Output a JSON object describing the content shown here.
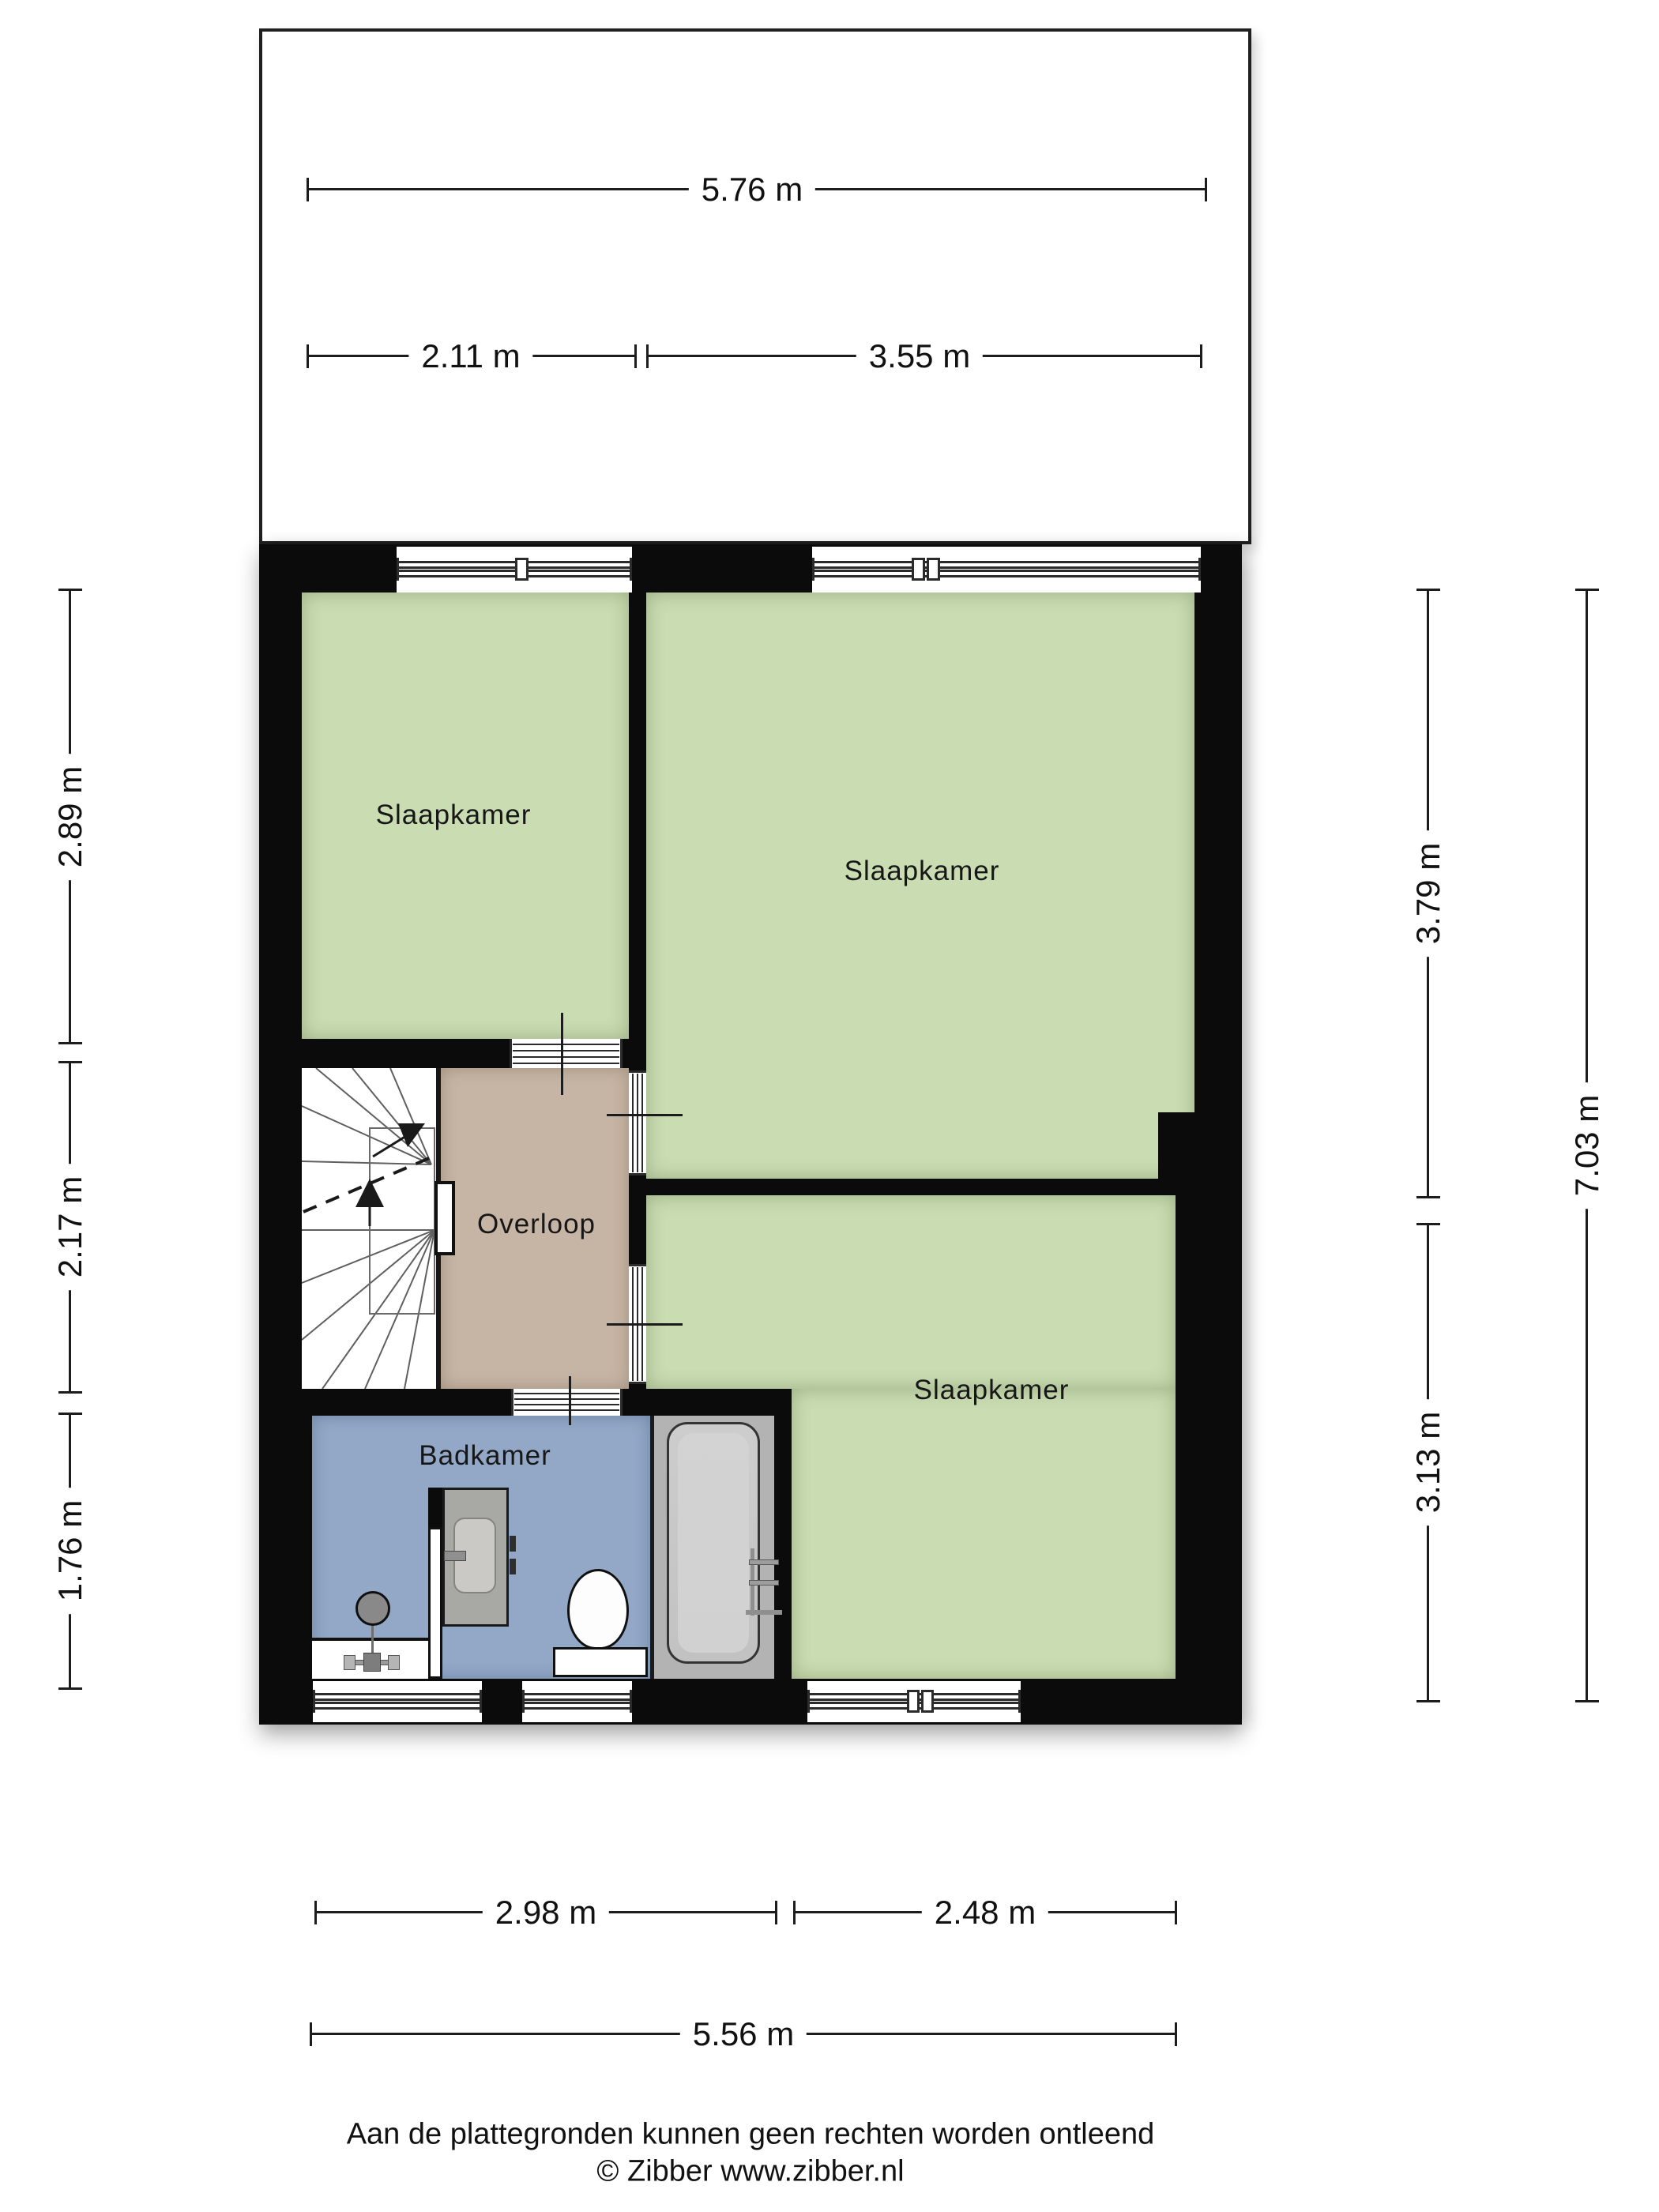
{
  "plan": {
    "type": "floorplan",
    "floor_note": "upper floor with three bedrooms, landing and bathroom",
    "rooms": {
      "bedroom1": "Slaapkamer",
      "bedroom2": "Slaapkamer",
      "bedroom3": "Slaapkamer",
      "landing": "Overloop",
      "bathroom": "Badkamer"
    }
  },
  "dimensions": {
    "top_total": "5.76 m",
    "top_left": "2.11 m",
    "top_right": "3.55 m",
    "left_top": "2.89 m",
    "left_middle": "2.17 m",
    "left_bottom": "1.76 m",
    "right_top": "3.79 m",
    "right_bottom": "3.13 m",
    "right_total": "7.03 m",
    "bottom_left": "2.98 m",
    "bottom_right": "2.48 m",
    "bottom_total": "5.56 m"
  },
  "footer": {
    "disclaimer": "Aan de plattegronden kunnen geen rechten worden ontleend",
    "credit": "© Zibber www.zibber.nl"
  },
  "colors": {
    "wall": "#0b0b0b",
    "bedroom_fill": "#cadcb2",
    "landing_fill": "#c6b5a4",
    "bathroom_fill": "#92a8c6",
    "bathtub_fill": "#c8c8c8",
    "dimension_line": "#1c1c1c"
  }
}
